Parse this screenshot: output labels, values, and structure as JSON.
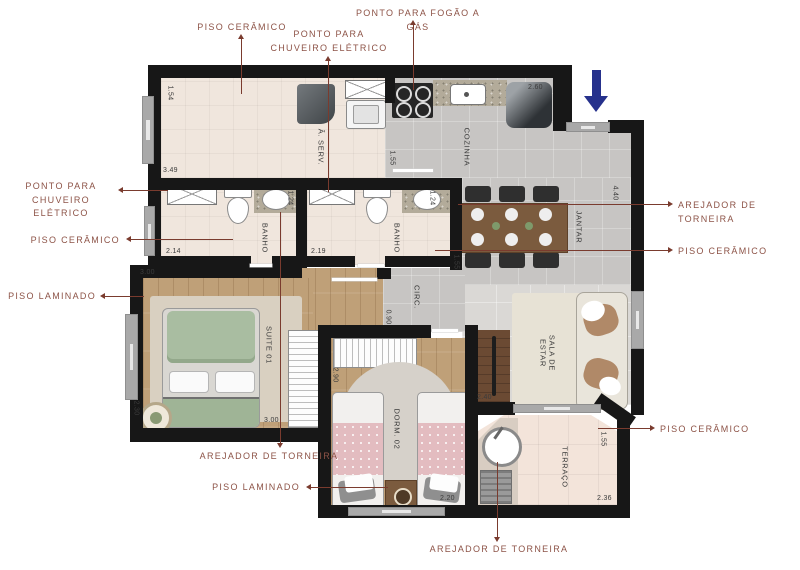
{
  "plan_title": "apartment-floor-plan",
  "colors": {
    "wall": "#171717",
    "callout_text": "#8d5347",
    "callout_line": "#7a3b2e",
    "entry_arrow_blue": "#26318c",
    "wood_floor": "#bfa078",
    "tile_floor": "#c7c5c3",
    "ceramic_floor": "#f0e6dd",
    "terrace_floor": "#f3e4da"
  },
  "icons": {
    "entry_arrow": "down-arrow"
  },
  "callouts": {
    "top_piso_ceramico": "PISO CERÂMICO",
    "top_ponto_chuveiro": "PONTO PARA\nCHUVEIRO ELÉTRICO",
    "top_ponto_fogao": "PONTO PARA FOGÃO A GÁS",
    "left_ponto_chuveiro": "PONTO PARA\nCHUVEIRO ELÉTRICO",
    "left_piso_ceramico": "PISO CERÂMICO",
    "left_piso_laminado": "PISO LAMINADO",
    "right_arejador": "AREJADOR DE TORNEIRA",
    "right_piso_ceramico": "PISO CERÂMICO",
    "terrace_piso_ceramico": "PISO CERÂMICO",
    "bottom_arejador_banho": "AREJADOR DE TORNEIRA",
    "bottom_piso_laminado": "PISO LAMINADO",
    "bottom_arejador_terraco": "AREJADOR DE TORNEIRA"
  },
  "rooms": {
    "servico": "Â. SERV.",
    "cozinha": "COZINHA",
    "banho1": "BANHO",
    "banho2": "BANHO",
    "jantar": "JANTAR",
    "circ": "CIRC.",
    "suite": "SUITE 01",
    "dorm": "DORM. 02",
    "sala": "SALA DE\nESTAR",
    "terraco": "TERRAÇO"
  },
  "dims": {
    "servico_h": "1.54",
    "servico_w": "3.49",
    "banho1_w": "2.14",
    "banho1_h": "1.24",
    "banho2_w": "2.19",
    "banho2_h": "1.24",
    "cozinha_door": "1.55",
    "cozinha_w": "2.60",
    "entrada_h": "4.40",
    "jantar_h": "1.55",
    "suite_w_top": "3.00",
    "suite_h": "2.30",
    "suite_w": "3.00",
    "dorm_h": "2.90",
    "dorm_w": "2.20",
    "rack_w": "2.40",
    "circ_w": "0.90",
    "terraco_h": "1.55",
    "terraco_w": "2.36"
  }
}
